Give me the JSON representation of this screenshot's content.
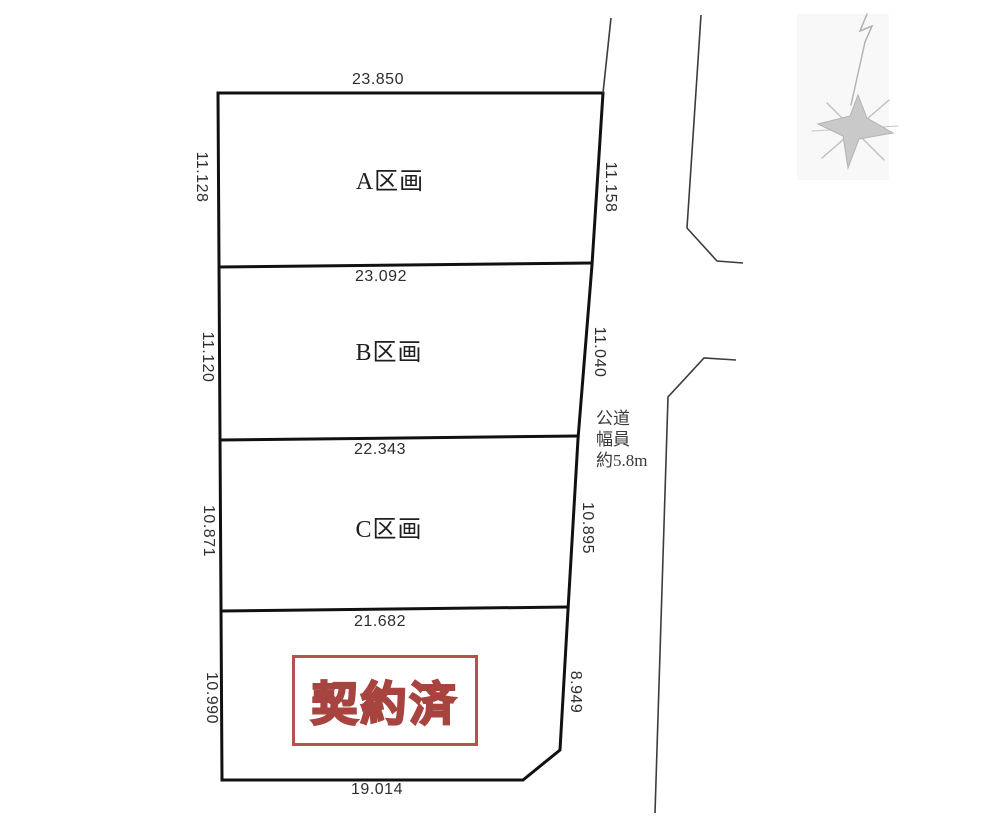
{
  "diagram_title": "land-subdivision-plot-plan",
  "plots": [
    {
      "id": "A",
      "label": "A区画",
      "top_dim": "23.850",
      "left_dim": "11.128",
      "right_dim": "11.158"
    },
    {
      "id": "B",
      "label": "B区画",
      "top_dim": "23.092",
      "left_dim": "11.120",
      "right_dim": "11.040"
    },
    {
      "id": "C",
      "label": "C区画",
      "top_dim": "22.343",
      "left_dim": "10.871",
      "right_dim": "10.895"
    },
    {
      "id": "D",
      "label": "契約済",
      "top_dim": "21.682",
      "left_dim": "10.990",
      "right_dim": "8.949",
      "bottom_dim": "19.014"
    }
  ],
  "road": {
    "label_line1": "公道",
    "label_line2": "幅員",
    "label_line3": "約5.8m"
  },
  "stamp": {
    "label": "契約済"
  },
  "colors": {
    "plot_line": "#111111",
    "road_line": "#3c3c3c",
    "stamp_border": "#b5524c",
    "stamp_text_fill": "#e9b3ae",
    "stamp_text_stroke": "#a84440",
    "compass": "#c2c2c2"
  }
}
